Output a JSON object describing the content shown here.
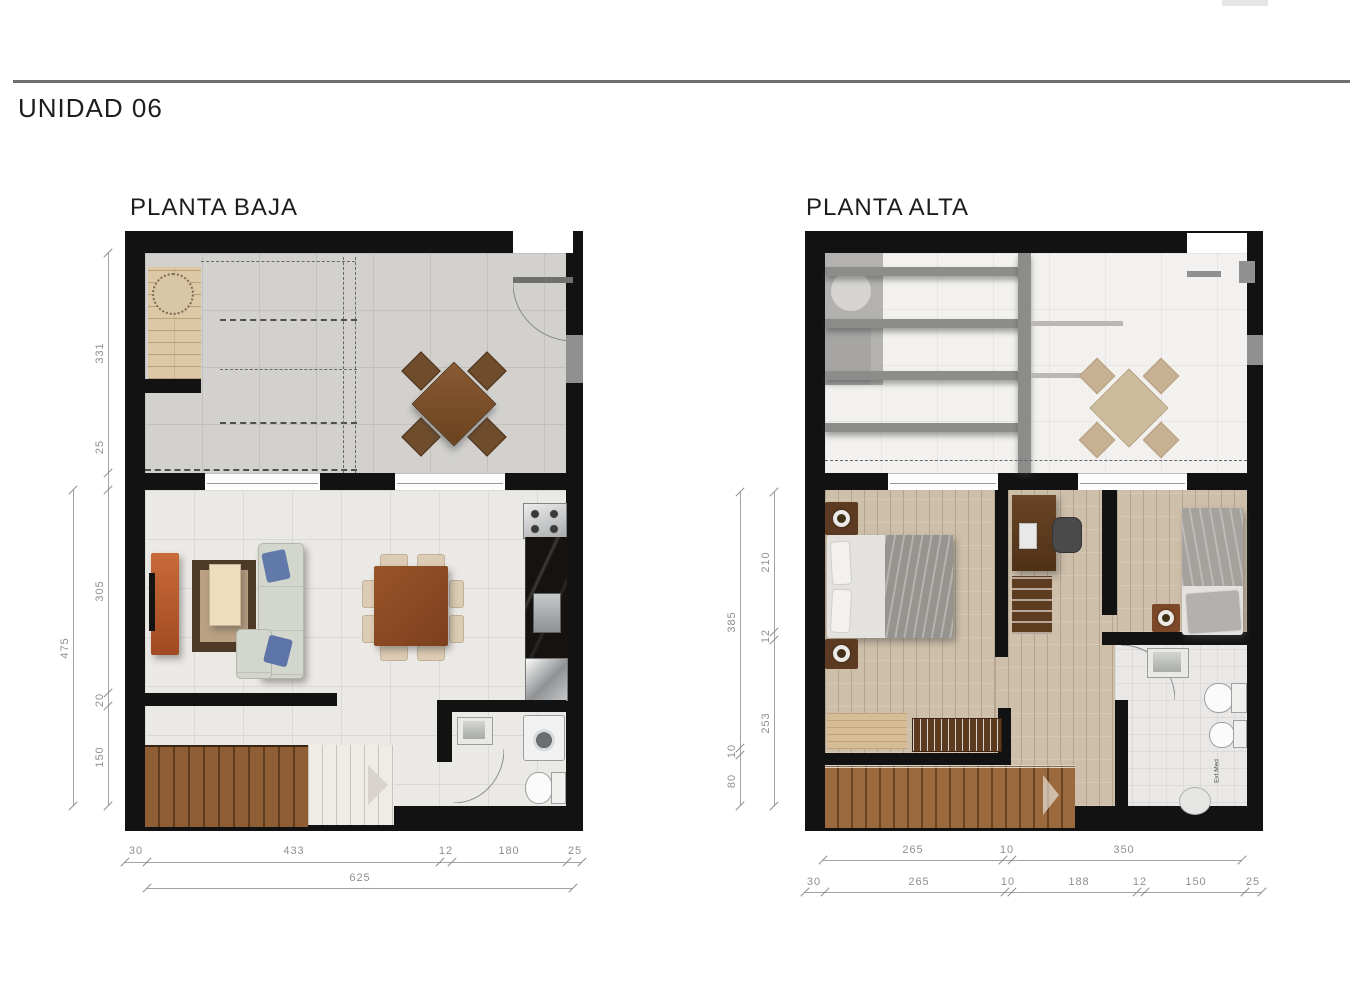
{
  "page": {
    "title": "UNIDAD 06"
  },
  "plans": {
    "baja": {
      "label": "PLANTA BAJA",
      "left_dims": [
        "331",
        "25",
        "305",
        "20",
        "150"
      ],
      "left_total": "475",
      "bottom_dims": [
        "30",
        "433",
        "12",
        "180",
        "25"
      ],
      "bottom_total": "625"
    },
    "alta": {
      "label": "PLANTA ALTA",
      "left_dims": [
        "210",
        "12",
        "253"
      ],
      "left_outer": [
        "385",
        "10",
        "80"
      ],
      "bottom_upper": [
        "265",
        "10",
        "350"
      ],
      "bottom_dims": [
        "30",
        "265",
        "10",
        "188",
        "12",
        "150",
        "25"
      ],
      "vent_label": "Ext.Med"
    }
  },
  "colors": {
    "wall": "#121212",
    "dim_text": "#8f8f8f",
    "stair_wood": "#8f5e35",
    "sideboard_orange": "#c96a38",
    "sofa_gray": "#d3d6cc",
    "pillow_blue": "#5d74a8"
  }
}
